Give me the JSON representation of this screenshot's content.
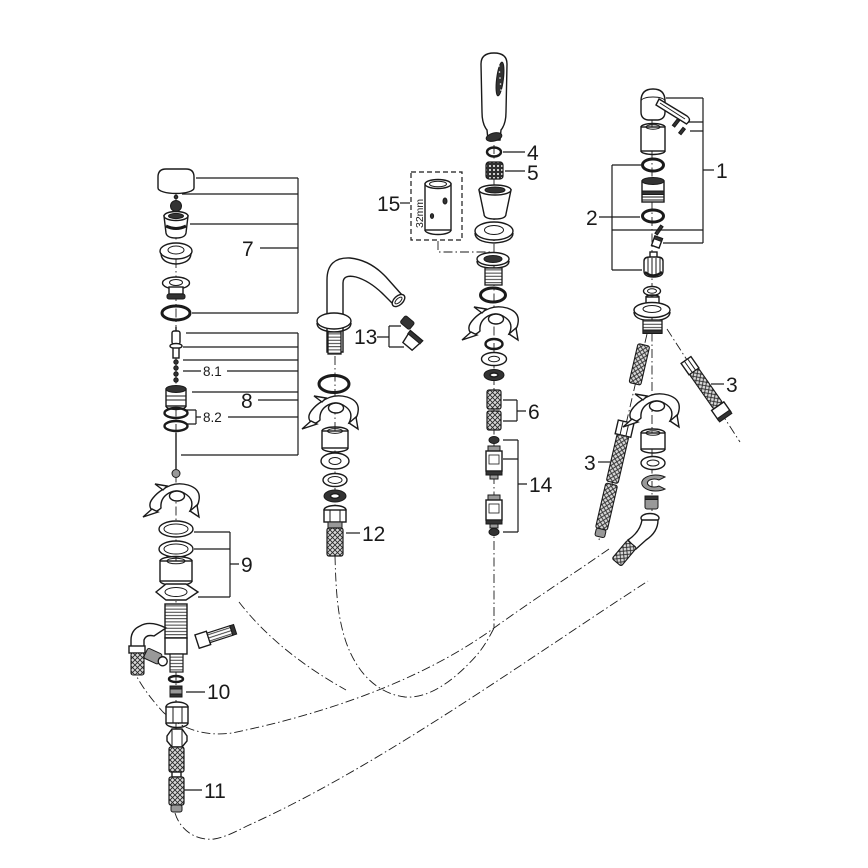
{
  "diagram": {
    "background_color": "#ffffff",
    "line_color": "#1a1a1a",
    "type": "exploded-parts-diagram",
    "callouts": {
      "n1": {
        "label": "1",
        "part": "lever-handle-assembly"
      },
      "n2": {
        "label": "2",
        "part": "seal-cartridge-kit"
      },
      "n3a": {
        "label": "3",
        "part": "flexible-connection-hose-left"
      },
      "n3b": {
        "label": "3",
        "part": "flexible-connection-hose-right"
      },
      "n4": {
        "label": "4",
        "part": "o-ring"
      },
      "n5": {
        "label": "5",
        "part": "filter-insert"
      },
      "n6": {
        "label": "6",
        "part": "hose-section-pair"
      },
      "n7": {
        "label": "7",
        "part": "cap-and-waste-set"
      },
      "n8": {
        "label": "8",
        "part": "pull-rod-assembly"
      },
      "n81": {
        "label": "8.1",
        "part": "bead-chain"
      },
      "n82": {
        "label": "8.2",
        "part": "o-ring-pair"
      },
      "n9": {
        "label": "9",
        "part": "mounting-set"
      },
      "n10": {
        "label": "10",
        "part": "adapter-sleeve"
      },
      "n11": {
        "label": "11",
        "part": "braided-hose"
      },
      "n12": {
        "label": "12",
        "part": "connection-hose-spout"
      },
      "n13": {
        "label": "13",
        "part": "aerator-set"
      },
      "n14": {
        "label": "14",
        "part": "check-valve-set"
      },
      "n15": {
        "label": "15",
        "part": "extension-piece"
      }
    },
    "dimension_labels": {
      "extension_length": "32mm"
    }
  }
}
